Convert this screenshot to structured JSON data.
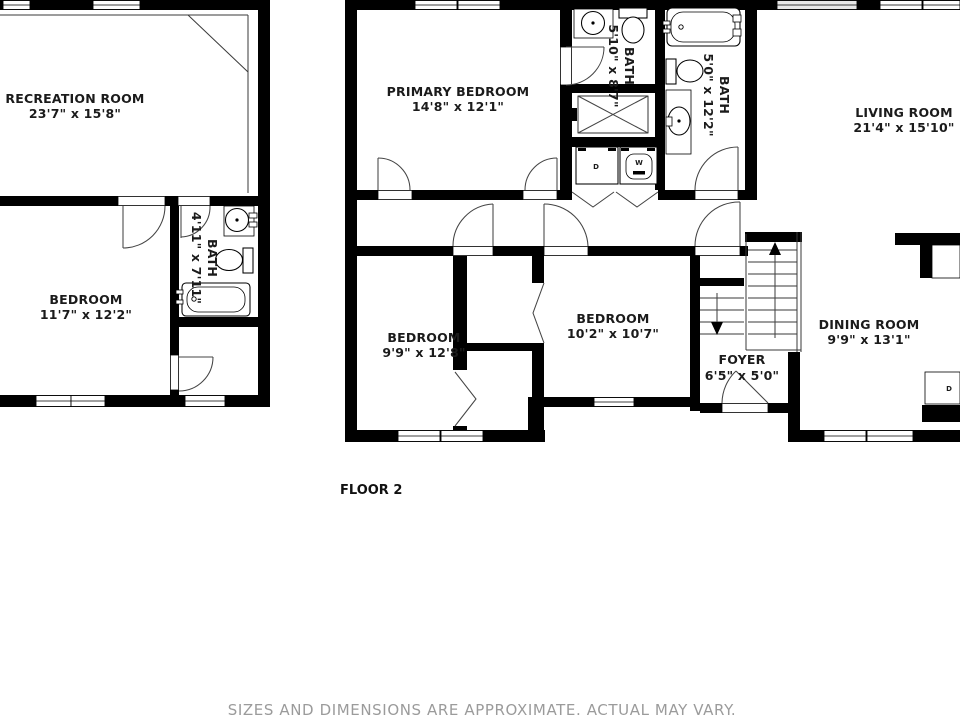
{
  "floor_label": "FLOOR 2",
  "disclaimer": "SIZES AND DIMENSIONS ARE APPROXIMATE. ACTUAL MAY VARY.",
  "rooms": {
    "recreation": {
      "name": "RECREATION ROOM",
      "dims": "23'7\" x 15'8\""
    },
    "bedroom_left": {
      "name": "BEDROOM",
      "dims": "11'7\" x 12'2\""
    },
    "bath_left": {
      "name": "BATH",
      "dims": "4'11\" x 7'11\""
    },
    "primary": {
      "name": "PRIMARY BEDROOM",
      "dims": "14'8\" x 12'1\""
    },
    "bath_upper": {
      "name": "BATH",
      "dims": "5'10\" x 8'7\""
    },
    "bath_right": {
      "name": "BATH",
      "dims": "5'0\" x 12'2\""
    },
    "living": {
      "name": "LIVING ROOM",
      "dims": "21'4\" x 15'10\""
    },
    "bedroom_mid": {
      "name": "BEDROOM",
      "dims": "9'9\" x 12'8\""
    },
    "bedroom_right": {
      "name": "BEDROOM",
      "dims": "10'2\" x 10'7\""
    },
    "foyer": {
      "name": "FOYER",
      "dims": "6'5\" x 5'0\""
    },
    "dining": {
      "name": "DINING ROOM",
      "dims": "9'9\" x 13'1\""
    }
  },
  "appliances": {
    "dryer_label": "D",
    "washer_label": "W",
    "dishwasher_label": "D"
  },
  "colors": {
    "wall": "#000000",
    "background": "#ffffff",
    "label_text": "#1b1b1b",
    "disclaimer_text": "#9b9b9b"
  }
}
